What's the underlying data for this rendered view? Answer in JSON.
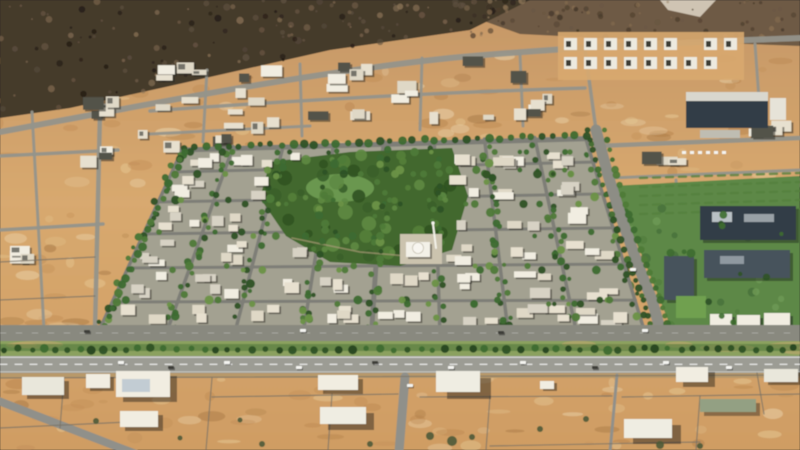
{
  "scene_description": "Aerial 3D rendering of a walled desert city district: dark rocky mountains across the top, a dense master-planned residential community with tree-lined streets, a central green park with a small mosque, a landscaped campus with dark roofs at right, a divided highway with a planted median running horizontally near the bottom, and empty walled desert plots with scattered white buildings below it. No text is rendered anywhere in the image.",
  "palette": {
    "desertTop": "#c59767",
    "desertMid": "#d8a96f",
    "desertBottom": "#cf9d64",
    "mottleLight": "#ecd3a0",
    "mottleDark": "#b27d46",
    "mottleMid": "#c08c55",
    "mottlePale": "#f2e2c0",
    "mottleDeep": "#9d6f3e",
    "mountainBase": "#453a2c",
    "mountainRight": "#6e5a44",
    "mountainBright": "#d9cfc0",
    "road": "#90908a",
    "roadLight": "#93938b",
    "roadDark": "#7e7e77",
    "asphalt": "#9c9c94",
    "service": "#89897f",
    "devBase": "#a3a191",
    "park": "#42682e",
    "lawnLight": "#71a055",
    "building": "#f1ede1",
    "buildingAlt": "#e7e0cf",
    "buildingDim": "#dfd8c6",
    "shed": "#52524a",
    "treeDark": "#2e5226",
    "tree": "#3e6b30",
    "treeMid": "#4f7a38",
    "treeLight": "#6b9246",
    "campusLawn": "#5d8847",
    "roofDark": "#333e46",
    "roof": "#46525c",
    "field": "#6fa04f",
    "medianGrass": "#8ba15f",
    "hedge": "#4b7539",
    "shoulder": "#b8996a",
    "wall": "#7b7365",
    "shrub": "#4c5a38",
    "carWhite": "#f4f4f0",
    "carDark": "#3c3c38",
    "mosqueWhite": "#f3f1e8",
    "plaza": "#cbc3ae"
  },
  "scene": {
    "mountains": {
      "ridge": [
        [
          0,
          118
        ],
        [
          70,
          108
        ],
        [
          170,
          86
        ],
        [
          330,
          50
        ],
        [
          470,
          30
        ],
        [
          530,
          0
        ]
      ],
      "darkPoly": "0,0 530,0 470,30 330,50 170,86 70,108 0,118",
      "rightPoly": "470,0 800,0 800,46 640,40 520,34 470,16",
      "brightPatch": "660,0 716,0 700,17 668,10"
    },
    "roads": [
      {
        "d": "M0,132 C150,104 300,74 450,58 C580,46 700,42 800,38",
        "w": 6
      },
      {
        "d": "M100,112 L95,330",
        "w": 4.5
      },
      {
        "d": "M0,156 L118,150",
        "w": 3.5
      },
      {
        "d": "M0,230 L103,224",
        "w": 3.5
      },
      {
        "d": "M32,112 L44,330",
        "w": 3
      },
      {
        "d": "M150,111 C300,100 450,92 585,88",
        "w": 3.5
      },
      {
        "d": "M150,134 L310,126",
        "w": 3
      },
      {
        "d": "M207,70 L203,142",
        "w": 3
      },
      {
        "d": "M300,64 L302,136",
        "w": 3
      },
      {
        "d": "M422,58 L420,130",
        "w": 3
      },
      {
        "d": "M520,54 L523,126",
        "w": 3
      },
      {
        "d": "M585,50 L596,130",
        "w": 3.5
      },
      {
        "d": "M596,146 L800,138",
        "w": 4.5
      },
      {
        "d": "M755,44 L762,140",
        "w": 3
      },
      {
        "d": "M610,178 L800,170",
        "w": 3
      },
      {
        "d": "M676,180 L686,335",
        "w": 3
      }
    ],
    "clusters": [
      {
        "b": [
          150,
          62,
          140,
          56
        ],
        "n": 10
      },
      {
        "b": [
          50,
          88,
          92,
          42
        ],
        "n": 5
      },
      {
        "b": [
          135,
          108,
          162,
          50
        ],
        "n": 9
      },
      {
        "b": [
          58,
          146,
          72,
          24
        ],
        "n": 3
      },
      {
        "b": [
          305,
          62,
          152,
          70
        ],
        "n": 12
      },
      {
        "b": [
          462,
          55,
          98,
          68
        ],
        "n": 8
      },
      {
        "b": [
          718,
          118,
          80,
          20
        ],
        "n": 4
      },
      {
        "b": [
          640,
          148,
          58,
          24
        ],
        "n": 3
      },
      {
        "b": [
          0,
          244,
          44,
          24
        ],
        "n": 3
      }
    ],
    "compound": {
      "b": [
        558,
        32,
        186,
        48
      ]
    },
    "dev": {
      "tl": [
        183,
        148
      ],
      "tr": [
        585,
        136
      ],
      "bl": [
        98,
        333
      ],
      "br": [
        645,
        333
      ],
      "hys": [
        150,
        172,
        202,
        234,
        268,
        302,
        331
      ],
      "park": "270,162 350,152 452,148 468,196 452,250 400,266 330,262 286,236 260,198",
      "parkEllipse": [
        362,
        204,
        100,
        56
      ],
      "lawn": [
        340,
        188,
        34,
        14
      ],
      "mosque": {
        "plaza": [
          400,
          234,
          42,
          30
        ],
        "hall": [
          406,
          242,
          24,
          15
        ],
        "dome": [
          418,
          248,
          5.5
        ],
        "minaret": [
          433,
          224,
          436,
          248
        ]
      }
    },
    "avenuePts": [
      [
        596,
        130
      ],
      [
        608,
        175
      ],
      [
        622,
        220
      ],
      [
        638,
        265
      ],
      [
        652,
        300
      ],
      [
        662,
        336
      ]
    ],
    "campus": {
      "lawn": "612,186 800,176 800,338 676,340 644,260 622,210",
      "hedgeRows": 5,
      "buildings": [
        [
          700,
          206,
          96,
          34
        ],
        [
          704,
          250,
          86,
          28
        ],
        [
          664,
          256,
          30,
          44
        ]
      ],
      "fieldRect": [
        676,
        296,
        30,
        22
      ],
      "whiteRow": [
        [
          710,
          314,
          22,
          13
        ],
        [
          737,
          315,
          23,
          13
        ],
        [
          764,
          313,
          26,
          14
        ]
      ],
      "industrial": {
        "main": [
          686,
          92,
          82,
          36
        ],
        "stripe": [
          686,
          92,
          82,
          9
        ],
        "annex": [
          770,
          98,
          16,
          22
        ],
        "dock": [
          700,
          130,
          40,
          8
        ]
      },
      "parkedCarsY": 151,
      "parkedCarsX0": 682,
      "parkedCarsN": 6
    },
    "highway": {
      "service": [
        0,
        325,
        800,
        16
      ],
      "median": [
        0,
        341,
        800,
        15
      ],
      "main": [
        0,
        356,
        800,
        17
      ],
      "shoulder": [
        0,
        373,
        800,
        5
      ]
    },
    "vehicles": {
      "main": [
        [
          118,
          361,
          1
        ],
        [
          168,
          366,
          0
        ],
        [
          224,
          361,
          1
        ],
        [
          296,
          366,
          1
        ],
        [
          372,
          361,
          0
        ],
        [
          448,
          366,
          1
        ],
        [
          520,
          361,
          1
        ],
        [
          592,
          366,
          0
        ],
        [
          663,
          361,
          1
        ],
        [
          726,
          366,
          1
        ]
      ],
      "service": [
        [
          84,
          330,
          0
        ],
        [
          300,
          329,
          1
        ],
        [
          498,
          331,
          0
        ],
        [
          642,
          329,
          1
        ]
      ],
      "other": [
        [
          407,
          384,
          1
        ],
        [
          630,
          268,
          1
        ]
      ]
    },
    "bottom": {
      "roads": [
        {
          "d": "M405,377 L399,452",
          "w": 9
        },
        {
          "d": "M-4,400 L136,454",
          "w": 8
        },
        {
          "d": "M617,375 L610,452",
          "w": 3
        }
      ],
      "walls": [
        "M0,378 L800,375",
        "M212,397 L398,394",
        "M420,397 L612,396",
        "M622,397 L800,394",
        "M212,378 L206,450",
        "M332,394 L328,450",
        "M490,396 L486,450",
        "M700,396 L696,450",
        "M757,373 L764,414",
        "M0,428 L128,422",
        "M490,446 L700,442",
        "M64,378 L60,428",
        "M0,262 L95,257",
        "M0,300 L95,296"
      ],
      "buildings": [
        [
          22,
          377,
          42,
          18,
          5,
          4
        ],
        [
          86,
          374,
          24,
          14,
          4,
          3
        ],
        [
          116,
          371,
          54,
          26,
          7,
          5
        ],
        [
          120,
          411,
          38,
          16,
          5,
          4
        ],
        [
          318,
          375,
          40,
          15,
          5,
          4
        ],
        [
          320,
          407,
          46,
          17,
          8,
          6
        ],
        [
          436,
          371,
          44,
          21,
          11,
          7
        ],
        [
          624,
          419,
          48,
          19,
          9,
          6
        ],
        [
          676,
          367,
          32,
          15,
          7,
          5
        ],
        [
          764,
          369,
          34,
          13,
          4,
          3
        ],
        [
          540,
          381,
          14,
          8,
          3,
          2
        ]
      ],
      "stripe": [
        122,
        379,
        28,
        13
      ],
      "greenBuilding": [
        700,
        399,
        56,
        13
      ],
      "shrubs": [
        [
          262,
          444,
          3
        ],
        [
          430,
          436,
          4
        ],
        [
          452,
          441,
          5
        ],
        [
          472,
          437,
          3
        ],
        [
          540,
          429,
          3
        ],
        [
          586,
          419,
          3
        ],
        [
          660,
          445,
          4
        ],
        [
          700,
          446,
          3
        ],
        [
          180,
          438,
          2.5
        ],
        [
          240,
          420,
          2.5
        ],
        [
          370,
          444,
          3
        ],
        [
          96,
          421,
          3
        ]
      ]
    },
    "mottleBoxes": [
      [
        0,
        55,
        800,
        95
      ],
      [
        0,
        150,
        150,
        185
      ],
      [
        560,
        150,
        240,
        56
      ],
      [
        0,
        375,
        800,
        75
      ]
    ]
  }
}
